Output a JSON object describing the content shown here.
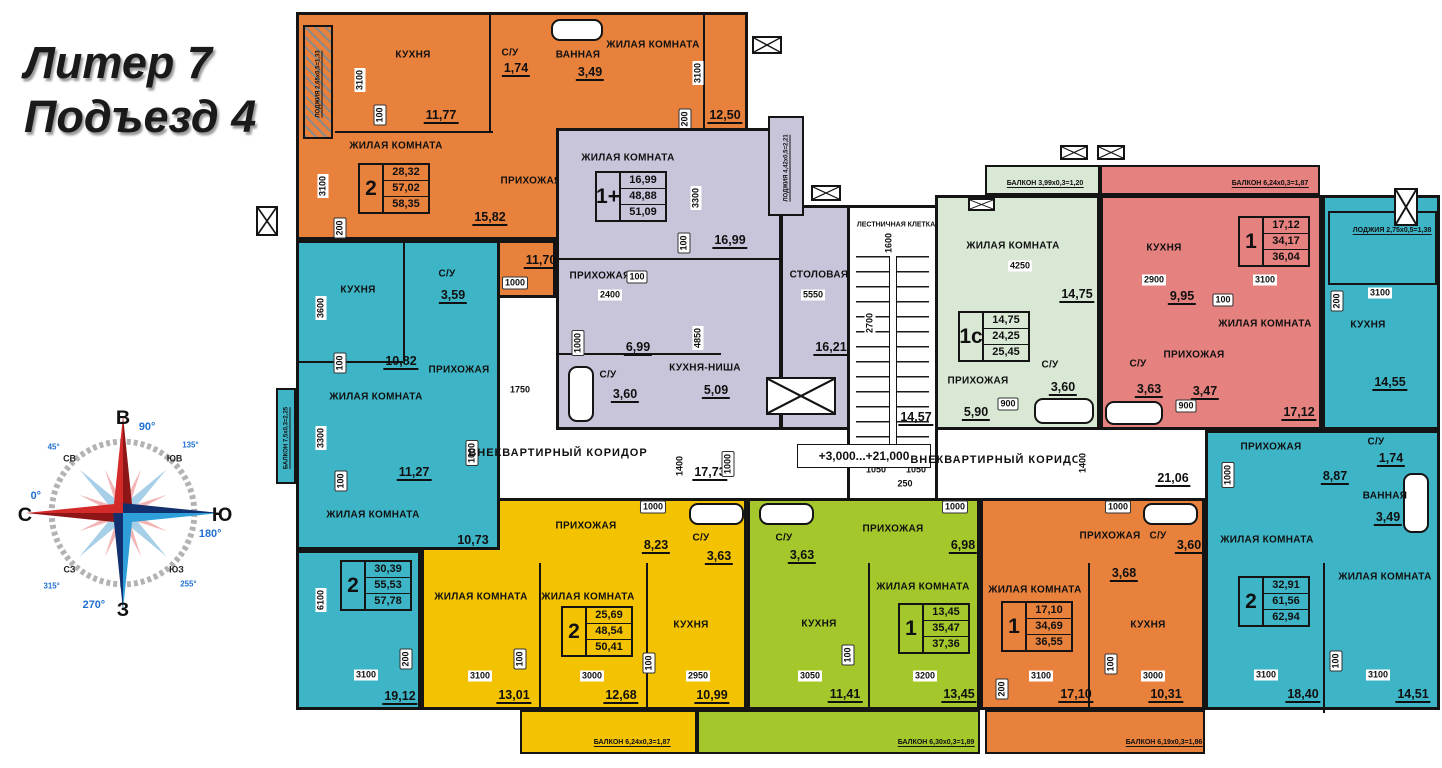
{
  "title": {
    "line1": "Литер 7",
    "line2": "Подъезд 4"
  },
  "compass": {
    "north": "С",
    "east": "В",
    "south": "Ю",
    "west": "З",
    "ne": "СВ",
    "se": "ЮВ",
    "sw": "ЮЗ",
    "nw": "СЗ",
    "deg_north": "0°",
    "deg_east": "90°",
    "deg_south": "180°",
    "deg_west": "270°",
    "deg_ne": "45°",
    "deg_se": "135°",
    "deg_sw": "255°",
    "deg_nw": "315°"
  },
  "colors": {
    "orange": "#e8813c",
    "purple": "#c8c5db",
    "teal": "#3eb5c7",
    "pale_green": "#d9e8d5",
    "red": "#e5817e",
    "yellow": "#f3c200",
    "green": "#a4c82b",
    "wall": "#141414"
  },
  "common": {
    "stairwell_label": "ЛЕСТНИЧНАЯ КЛЕТКА",
    "stairwell_area": "14,57",
    "corridor_label": "ВНЕКВАРТИРНЫЙ КОРИДОР",
    "corridor_left_area": "17,73",
    "corridor_right_area": "21,06",
    "elevation": "+3,000...+21,000"
  },
  "apartments": {
    "orange_top": {
      "spec": {
        "rooms": "2",
        "living": "28,32",
        "area": "57,02",
        "total": "58,35"
      },
      "loggia": "ЛОДЖИЯ 2,65х0,5=1,33",
      "kitchen": {
        "label": "КУХНЯ",
        "area": "11,77"
      },
      "living1": {
        "label": "ЖИЛАЯ КОМНАТА",
        "area": "15,82"
      },
      "living2": {
        "label": "ЖИЛАЯ КОМНАТА",
        "area": "12,50"
      },
      "wc": {
        "label": "С/У",
        "area": "1,74"
      },
      "bath": {
        "label": "ВАННАЯ",
        "area": "3,49"
      },
      "hall": {
        "label": "ПРИХОЖАЯ",
        "area": "11,70"
      }
    },
    "purple": {
      "spec": {
        "rooms": "1+",
        "living": "16,99",
        "area": "48,88",
        "total": "51,09"
      },
      "loggia": "ЛОДЖИЯ 4,42х0,5=2,21",
      "living": {
        "label": "ЖИЛАЯ КОМНАТА",
        "area": "16,99"
      },
      "hall": {
        "label": "ПРИХОЖАЯ",
        "area": "6,99"
      },
      "wc": {
        "label": "С/У",
        "area": "3,60"
      },
      "kitchen_niche": {
        "label": "КУХНЯ-НИША",
        "area": "5,09"
      },
      "dining": {
        "label": "СТОЛОВАЯ",
        "area": "16,21"
      }
    },
    "teal_left": {
      "spec": {
        "rooms": "2",
        "living": "30,39",
        "area": "55,53",
        "total": "57,78"
      },
      "balcony": "БАЛКОН 7,5х0,3=2,25",
      "kitchen": {
        "label": "КУХНЯ",
        "area": "10,82"
      },
      "wc": {
        "label": "С/У",
        "area": "3,59"
      },
      "hall": {
        "label": "ПРИХОЖАЯ"
      },
      "living1": {
        "label": "ЖИЛАЯ КОМНАТА",
        "area": "11,27"
      },
      "living2": {
        "label": "ЖИЛАЯ КОМНАТА",
        "area": "10,73"
      },
      "living3": {
        "label": "ЖИЛАЯ КОМНАТА",
        "area": "19,12"
      }
    },
    "green_1c": {
      "spec": {
        "rooms": "1с",
        "living": "14,75",
        "area": "24,25",
        "total": "25,45"
      },
      "balcony": "БАЛКОН 3,99х0,3=1,20",
      "living": {
        "label": "ЖИЛАЯ КОМНАТА",
        "area": "14,75"
      },
      "hall": {
        "label": "ПРИХОЖАЯ",
        "area": "5,90"
      },
      "wc": {
        "label": "С/У",
        "area": "3,60"
      }
    },
    "red": {
      "spec": {
        "rooms": "1",
        "living": "17,12",
        "area": "34,17",
        "total": "36,04"
      },
      "balcony": "БАЛКОН 6,24х0,3=1,87",
      "kitchen": {
        "label": "КУХНЯ",
        "area": "9,95"
      },
      "living": {
        "label": "ЖИЛАЯ КОМНАТА",
        "area": "17,12"
      },
      "hall": {
        "label": "ПРИХОЖАЯ",
        "area": "3,47"
      },
      "wc": {
        "label": "С/У",
        "area": "3,63"
      }
    },
    "teal_right": {
      "spec": {
        "rooms": "2",
        "living": "32,91",
        "area": "61,56",
        "total": "62,94"
      },
      "loggia": "ЛОДЖИЯ 2,75х0,5=1,38",
      "kitchen": {
        "label": "КУХНЯ",
        "area": "14,55"
      },
      "hall": {
        "label": "ПРИХОЖАЯ",
        "area": "8,87"
      },
      "wc": {
        "label": "С/У",
        "area": "1,74"
      },
      "bath": {
        "label": "ВАННАЯ",
        "area": "3,49"
      },
      "living1": {
        "label": "ЖИЛАЯ КОМНАТА",
        "area": "18,40"
      },
      "living2": {
        "label": "ЖИЛАЯ КОМНАТА",
        "area": "14,51"
      }
    },
    "yellow": {
      "spec": {
        "rooms": "2",
        "living": "25,69",
        "area": "48,54",
        "total": "50,41"
      },
      "balcony": "БАЛКОН 6,24х0,3=1,87",
      "hall": {
        "label": "ПРИХОЖАЯ",
        "area": "8,23"
      },
      "wc": {
        "label": "С/У",
        "area": "3,63"
      },
      "living1": {
        "label": "ЖИЛАЯ КОМНАТА",
        "area": "13,01"
      },
      "living2": {
        "label": "ЖИЛАЯ КОМНАТА",
        "area": "12,68"
      },
      "kitchen": {
        "label": "КУХНЯ",
        "area": "10,99"
      }
    },
    "green_bottom": {
      "spec": {
        "rooms": "1",
        "living": "13,45",
        "area": "35,47",
        "total": "37,36"
      },
      "balcony": "БАЛКОН 6,30х0,3=1,89",
      "hall": {
        "label": "ПРИХОЖАЯ",
        "area": "6,98"
      },
      "wc": {
        "label": "С/У",
        "area": "3,63"
      },
      "kitchen": {
        "label": "КУХНЯ",
        "area": "11,41"
      },
      "living": {
        "label": "ЖИЛАЯ КОМНАТА",
        "area": "13,45"
      }
    },
    "orange_bottom": {
      "spec": {
        "rooms": "1",
        "living": "17,10",
        "area": "34,69",
        "total": "36,55"
      },
      "balcony": "БАЛКОН 6,19х0,3=1,86",
      "living": {
        "label": "ЖИЛАЯ КОМНАТА",
        "area": "17,10"
      },
      "hall": {
        "label": "ПРИХОЖАЯ",
        "area": "3,68"
      },
      "wc": {
        "label": "С/У",
        "area": "3,60"
      },
      "kitchen": {
        "label": "КУХНЯ",
        "area": "10,31"
      }
    }
  },
  "dims": [
    "3100",
    "100",
    "3100",
    "200",
    "3100",
    "200",
    "1000",
    "3300",
    "100",
    "100",
    "2400",
    "1000",
    "4850",
    "5550",
    "1750",
    "1400",
    "1000",
    "3600",
    "100",
    "3300",
    "100",
    "1000",
    "6100",
    "200",
    "3100",
    "1600",
    "2700",
    "1050",
    "1050",
    "250",
    "4250",
    "900",
    "2900",
    "100",
    "3100",
    "900",
    "3100",
    "200",
    "1400",
    "1000",
    "3100",
    "100",
    "3100",
    "1000",
    "3100",
    "100",
    "3000",
    "100",
    "2950",
    "1000",
    "100",
    "3050",
    "3200",
    "1000",
    "100",
    "3000",
    "3100",
    "200"
  ]
}
